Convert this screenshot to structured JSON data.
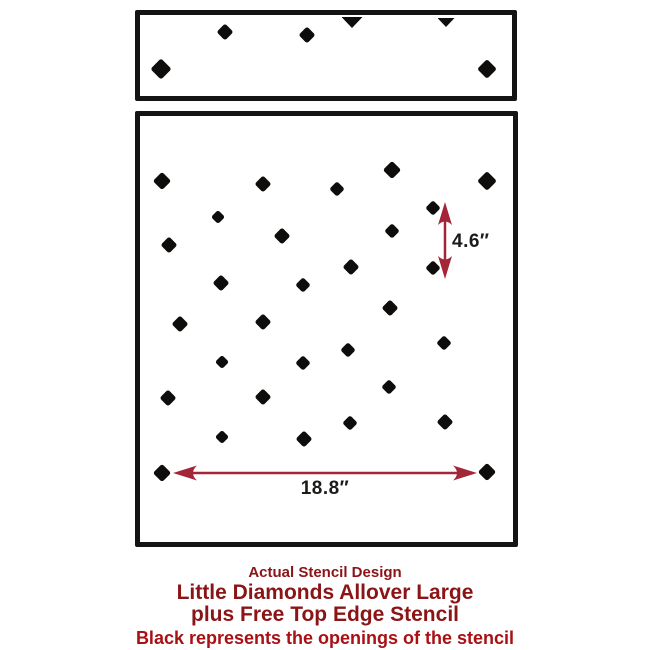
{
  "colors": {
    "diamond": "#0e0d0b",
    "panel_border": "#161412",
    "arrow": "#a32638",
    "dimension_text": "#1d1b19",
    "caption_red": "#8b1417",
    "notice_red": "#a81014"
  },
  "stencil": {
    "top_panel": {
      "diamonds": [
        {
          "x": 161,
          "y": 69,
          "d": 21
        },
        {
          "x": 225,
          "y": 32,
          "d": 16
        },
        {
          "x": 307,
          "y": 35,
          "d": 17
        },
        {
          "x": 487,
          "y": 69,
          "d": 19
        }
      ],
      "half_diamonds": [
        {
          "x": 352,
          "y": 17,
          "w": 21,
          "h": 11
        },
        {
          "x": 446,
          "y": 18,
          "w": 17,
          "h": 9
        }
      ]
    },
    "main_panel": {
      "diamonds": [
        {
          "x": 162,
          "y": 181,
          "d": 18
        },
        {
          "x": 263,
          "y": 184,
          "d": 17
        },
        {
          "x": 337,
          "y": 189,
          "d": 15
        },
        {
          "x": 392,
          "y": 170,
          "d": 18
        },
        {
          "x": 487,
          "y": 181,
          "d": 19
        },
        {
          "x": 433,
          "y": 208,
          "d": 15
        },
        {
          "x": 218,
          "y": 217,
          "d": 14
        },
        {
          "x": 282,
          "y": 236,
          "d": 16
        },
        {
          "x": 392,
          "y": 231,
          "d": 15
        },
        {
          "x": 169,
          "y": 245,
          "d": 16
        },
        {
          "x": 351,
          "y": 267,
          "d": 16
        },
        {
          "x": 433,
          "y": 268,
          "d": 15
        },
        {
          "x": 221,
          "y": 283,
          "d": 16
        },
        {
          "x": 303,
          "y": 285,
          "d": 15
        },
        {
          "x": 390,
          "y": 308,
          "d": 16
        },
        {
          "x": 180,
          "y": 324,
          "d": 17
        },
        {
          "x": 263,
          "y": 322,
          "d": 16
        },
        {
          "x": 444,
          "y": 343,
          "d": 15
        },
        {
          "x": 348,
          "y": 350,
          "d": 15
        },
        {
          "x": 222,
          "y": 362,
          "d": 14
        },
        {
          "x": 303,
          "y": 363,
          "d": 15
        },
        {
          "x": 389,
          "y": 387,
          "d": 15
        },
        {
          "x": 168,
          "y": 398,
          "d": 17
        },
        {
          "x": 263,
          "y": 397,
          "d": 16
        },
        {
          "x": 350,
          "y": 423,
          "d": 15
        },
        {
          "x": 445,
          "y": 422,
          "d": 16
        },
        {
          "x": 222,
          "y": 437,
          "d": 14
        },
        {
          "x": 304,
          "y": 439,
          "d": 16
        },
        {
          "x": 162,
          "y": 473,
          "d": 18
        },
        {
          "x": 487,
          "y": 472,
          "d": 18
        }
      ]
    }
  },
  "dimensions": {
    "vertical": {
      "label": "4.6″",
      "x": 445,
      "tip_top": 202,
      "tip_bottom": 279
    },
    "horizontal": {
      "label": "18.8″",
      "x_left": 173,
      "x_right": 477,
      "y": 473
    }
  },
  "caption": {
    "line1": "Actual Stencil Design",
    "line2": "Little Diamonds Allover Large",
    "line3": "plus Free Top Edge Stencil",
    "line4": "Black represents the openings of the stencil"
  }
}
